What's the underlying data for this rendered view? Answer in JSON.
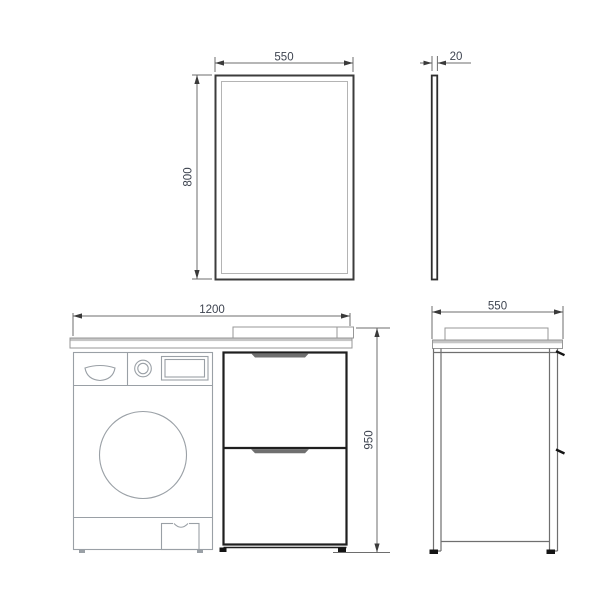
{
  "colors": {
    "background": "#ffffff",
    "thin_line": "#9aa0a6",
    "medium_line": "#6f6f6f",
    "thick_line": "#1f1f1f",
    "dimension_line": "#6e6e6e",
    "dimension_text": "#3e4450",
    "counter_band": "#c6c6c6"
  },
  "dimensions": {
    "mirror_width": "550",
    "mirror_height": "800",
    "mirror_thickness": "20",
    "vanity_width": "1200",
    "vanity_height": "950",
    "vanity_depth": "550"
  }
}
